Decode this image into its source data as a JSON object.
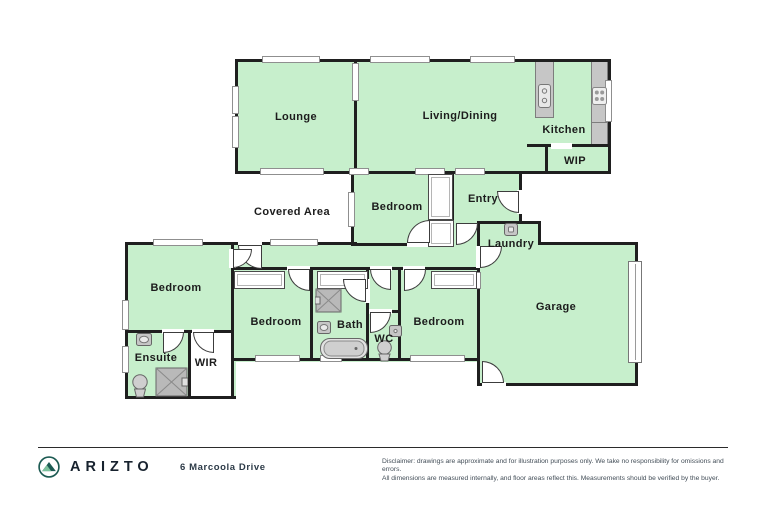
{
  "brand": {
    "name": "ARIZTO",
    "logo_icon": "mountain-circle-icon"
  },
  "floor_plan": {
    "labels": {
      "lounge": "Lounge",
      "living_dining": "Living/Dining",
      "kitchen": "Kitchen",
      "wip": "WIP",
      "covered_area": "Covered Area",
      "bedroom_mid": "Bedroom",
      "entry": "Entry",
      "laundry": "Laundry",
      "bedroom_master": "Bedroom",
      "ensuite": "Ensuite",
      "wir": "WIR",
      "bedroom2": "Bedroom",
      "bath": "Bath",
      "wc": "WC",
      "bedroom3": "Bedroom",
      "garage": "Garage"
    },
    "fixture_icons": [
      "double-sink",
      "stove",
      "washing-machine",
      "shower",
      "bathtub",
      "toilet",
      "vanity-sink",
      "garage-door",
      "wardrobe",
      "window",
      "door-swing"
    ],
    "colors": {
      "room_fill": "#c7efcc",
      "wall": "#1f1f1f",
      "fixture_gray": "#c6c6c6"
    }
  },
  "footer": {
    "address": "6 Marcoola Drive",
    "disclaimer_line1": "Disclaimer: drawings are approximate and for illustration purposes only. We take no responsibility for omissions and errors.",
    "disclaimer_line2": "All dimensions are measured internally, and floor areas reflect this. Measurements should be verified by the buyer.",
    "logo_teal": "#1d5b53"
  }
}
